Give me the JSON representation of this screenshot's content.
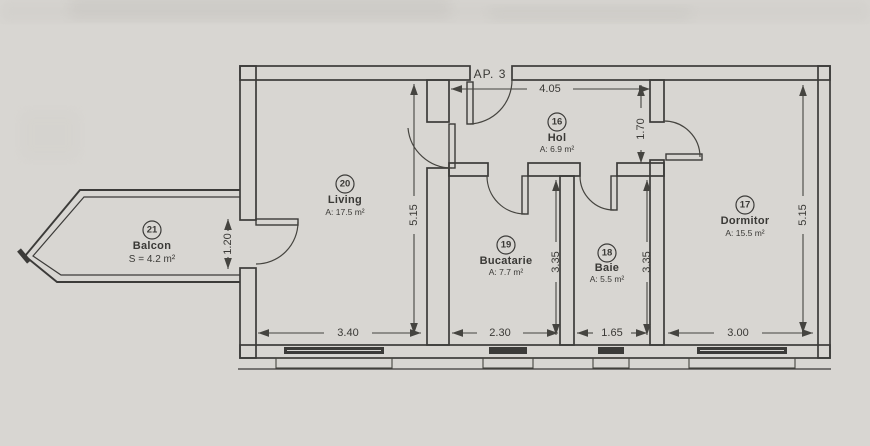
{
  "plan": {
    "apartment_label": "AP. 3",
    "rooms": {
      "hol": {
        "number": "16",
        "name": "Hol",
        "area": "A: 6.9 m²"
      },
      "dormitor": {
        "number": "17",
        "name": "Dormitor",
        "area": "A: 15.5 m²"
      },
      "baie": {
        "number": "18",
        "name": "Baie",
        "area": "A: 5.5 m²"
      },
      "bucatarie": {
        "number": "19",
        "name": "Bucatarie",
        "area": "A: 7.7 m²"
      },
      "living": {
        "number": "20",
        "name": "Living",
        "area": "A: 17.5 m²"
      },
      "balcon": {
        "number": "21",
        "name": "Balcon",
        "area": "S = 4.2 m²"
      }
    },
    "dimensions": {
      "hol_width": "4.05",
      "hol_depth": "1.70",
      "living_height": "5.15",
      "living_width": "3.40",
      "bucatarie_height": "3.35",
      "bucatarie_width": "2.30",
      "baie_height": "3.35",
      "baie_width": "1.65",
      "dormitor_height": "5.15",
      "dormitor_width": "3.00",
      "balcon_door_width": "1.20"
    },
    "colors": {
      "paper": "#d8d6d2",
      "ink": "#3c3b39"
    }
  }
}
